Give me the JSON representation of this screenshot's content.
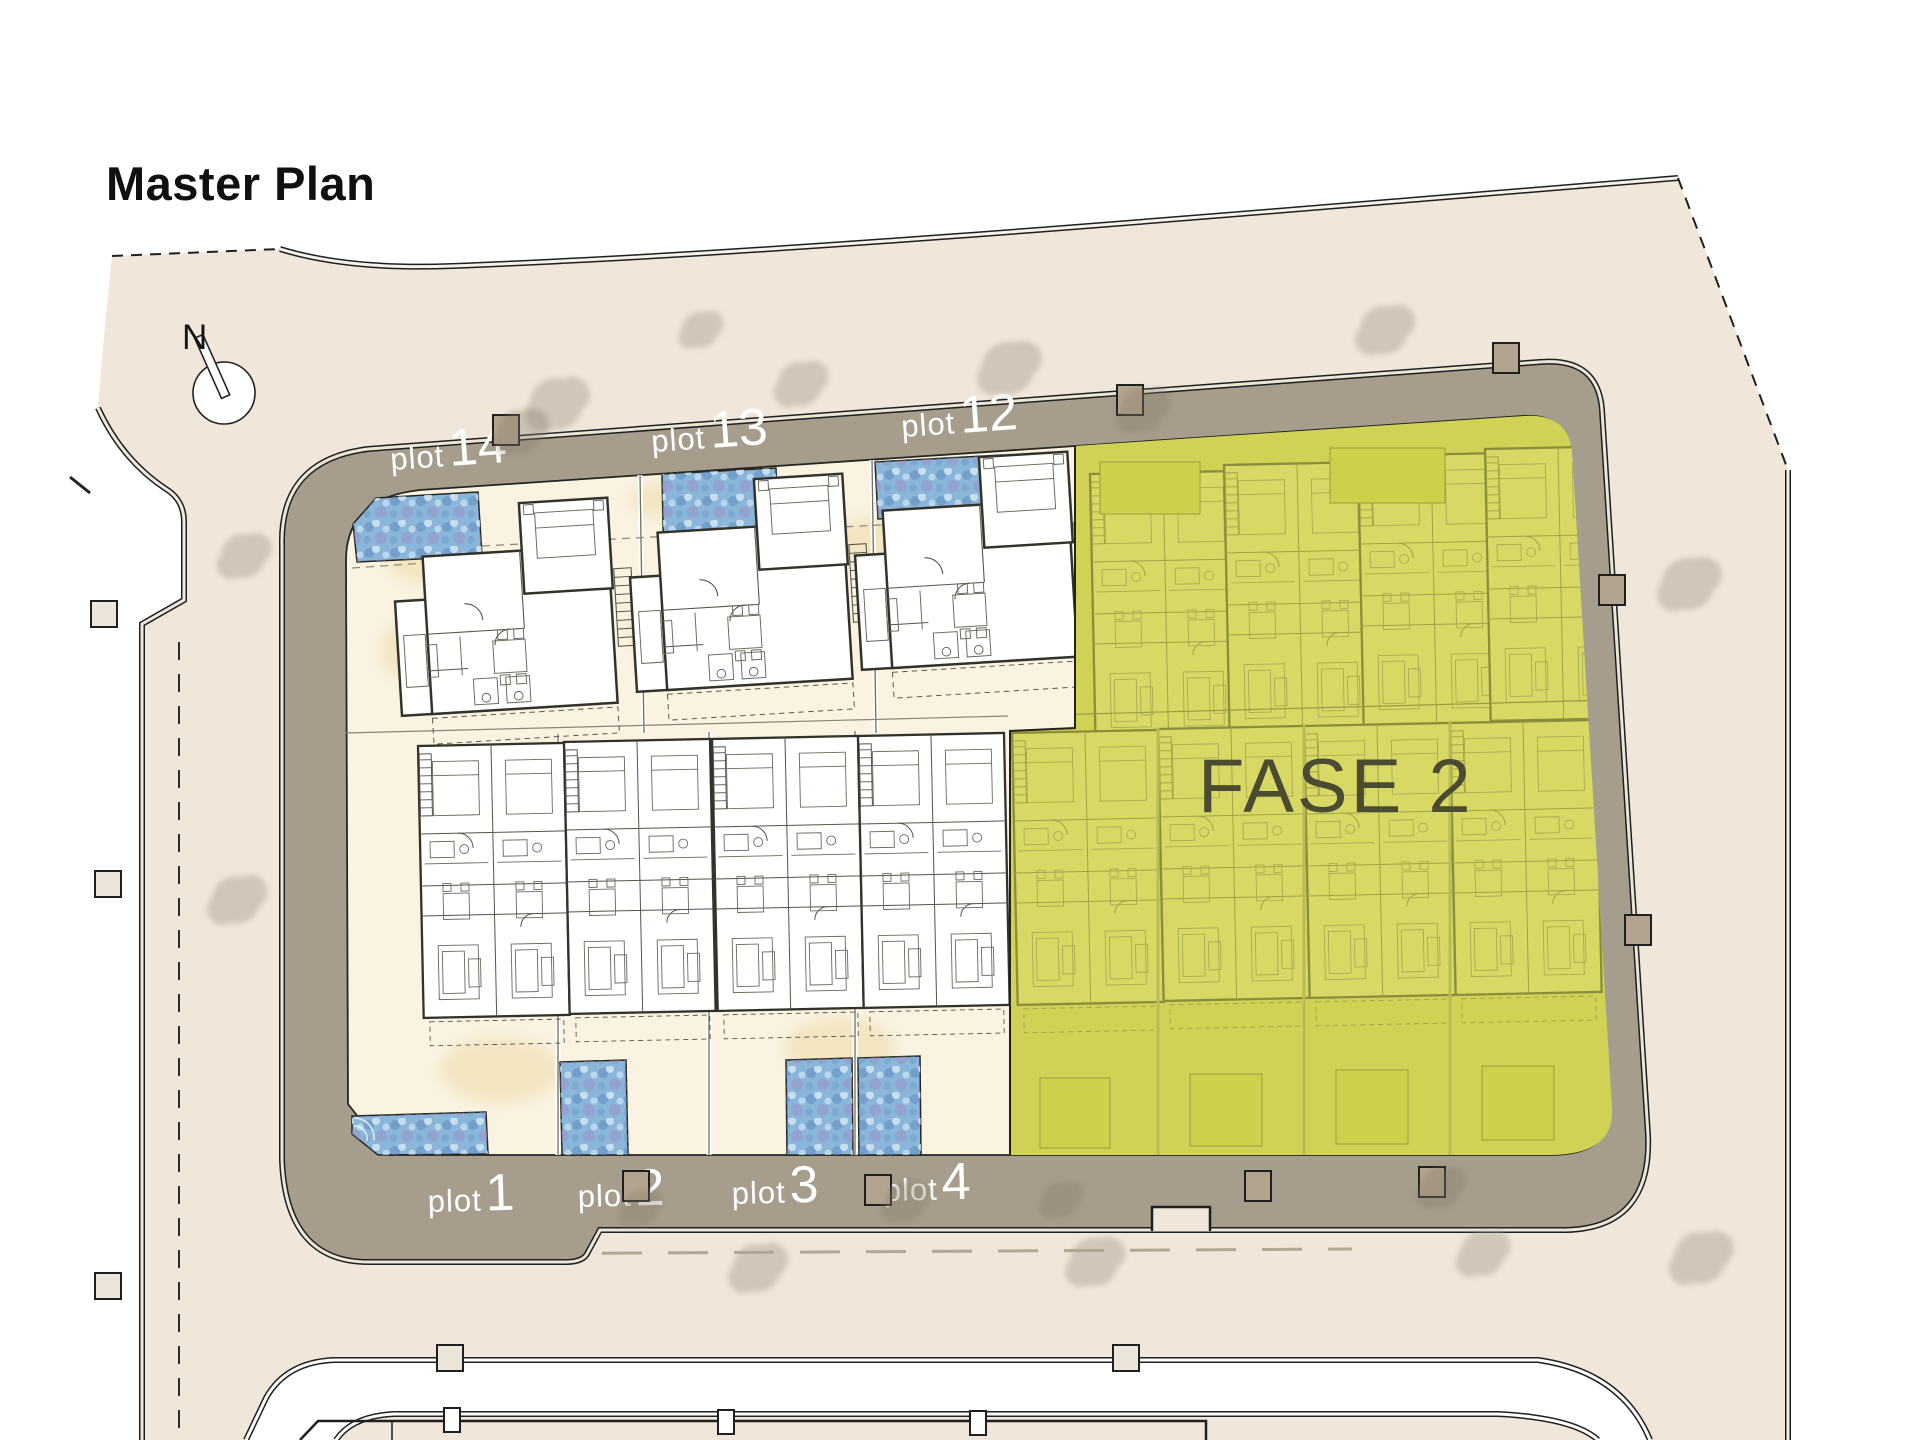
{
  "title": "Master Plan",
  "compass": {
    "label": "N"
  },
  "phase": {
    "label": "FASE 2"
  },
  "plots": {
    "top": [
      {
        "prefix": "plot",
        "number": "14"
      },
      {
        "prefix": "plot",
        "number": "13"
      },
      {
        "prefix": "plot",
        "number": "12"
      }
    ],
    "bottom": [
      {
        "prefix": "plot",
        "number": "1"
      },
      {
        "prefix": "plot",
        "number": "2"
      },
      {
        "prefix": "plot",
        "number": "3"
      },
      {
        "prefix": "plot",
        "number": "4"
      }
    ]
  },
  "colors": {
    "site_beige": "#f0e7da",
    "road_grey": "#a69d8d",
    "plot_cream": "#faf3e2",
    "sand_tint": "#ecd9a4",
    "phase_yellow": "#d0d255",
    "phase_text": "#4b4b31",
    "pool_base": "#8ab6d9",
    "pool_deep": "#5f8cbe",
    "pool_violet": "#9b90c6",
    "pool_light": "#d2e6f3",
    "wall_dark": "#32322a",
    "olive_wall": "#8b8d3a",
    "olive_fill": "#d8d964",
    "post_tan": "#b2a48e",
    "post_light": "#ece6da",
    "tree_grey": "#b0a698",
    "tree_brown": "#8a7c6a",
    "label_white": "#ffffff"
  }
}
